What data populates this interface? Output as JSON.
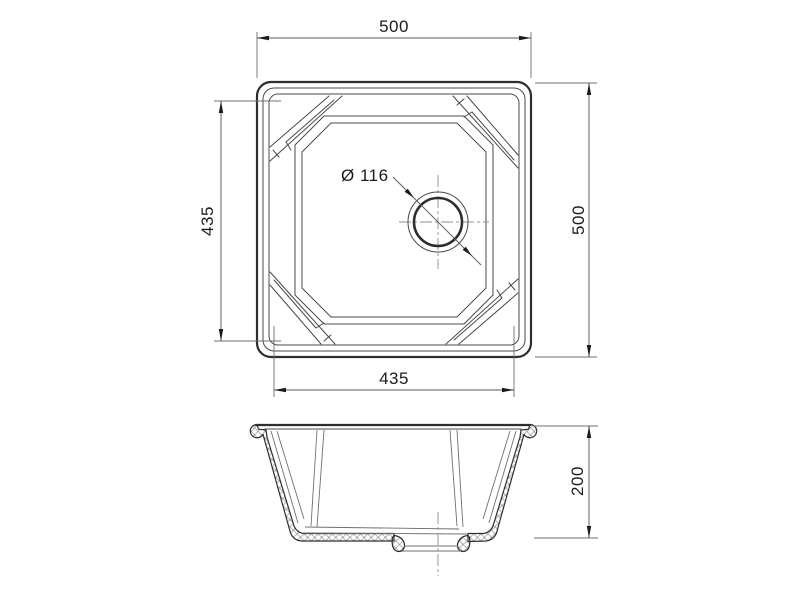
{
  "drawing": {
    "background": "#ffffff",
    "stroke_color": "#2e2e2e",
    "views": {
      "plan": {
        "name": "sink plan view",
        "dimensions": {
          "overall_width": {
            "value": 500,
            "label": "500",
            "position": "top"
          },
          "overall_depth": {
            "value": 500,
            "label": "500",
            "position": "right"
          },
          "bowl_depth": {
            "value": 435,
            "label": "435",
            "position": "left"
          },
          "bowl_width": {
            "value": 435,
            "label": "435",
            "position": "bottom"
          },
          "drain_diameter": {
            "value": 116,
            "label": "Ø 116",
            "position": "leader"
          }
        }
      },
      "section": {
        "name": "sink front section view",
        "dimensions": {
          "bowl_height": {
            "value": 200,
            "label": "200",
            "position": "right"
          }
        }
      }
    }
  }
}
